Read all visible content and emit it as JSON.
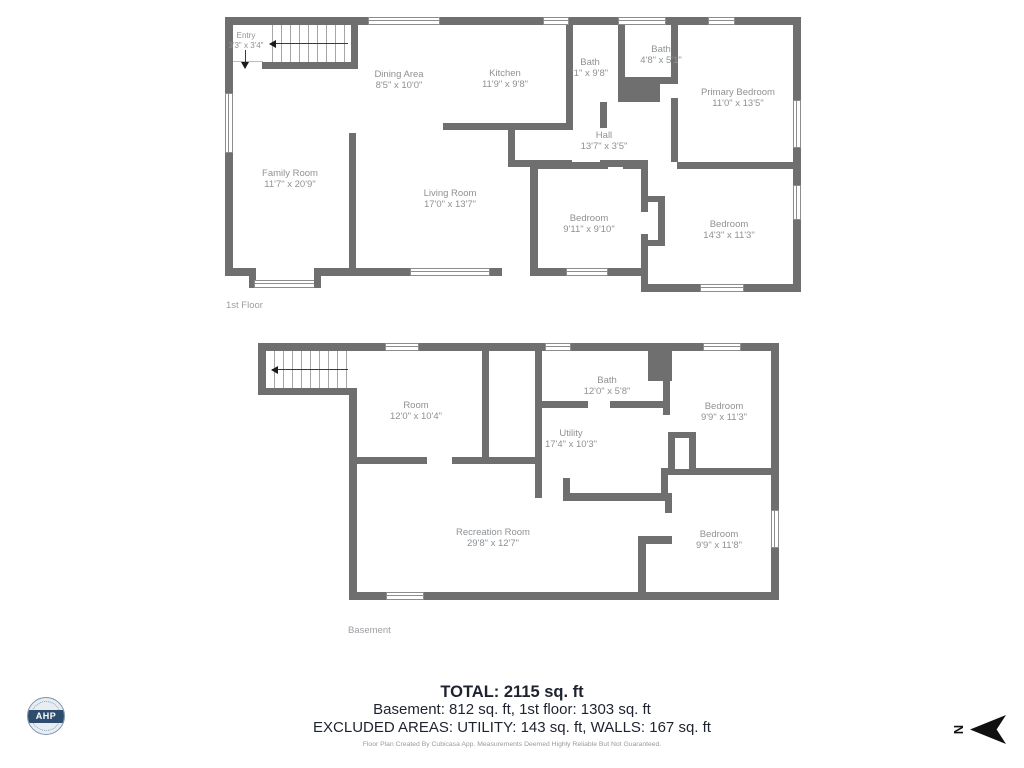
{
  "floors": [
    {
      "label": "1st Floor",
      "rooms": [
        {
          "name": "Entry",
          "dims": "3'3\" x 3'4\""
        },
        {
          "name": "Dining Area",
          "dims": "8'5\" x 10'0\""
        },
        {
          "name": "Kitchen",
          "dims": "11'9\" x 9'8\""
        },
        {
          "name": "Bath",
          "dims": "'1\" x 9'8\""
        },
        {
          "name": "Bath",
          "dims": "4'8\" x 5'1\""
        },
        {
          "name": "Primary Bedroom",
          "dims": "11'0\" x 13'5\""
        },
        {
          "name": "Hall",
          "dims": "13'7\" x 3'5\""
        },
        {
          "name": "Family Room",
          "dims": "11'7\" x 20'9\""
        },
        {
          "name": "Living Room",
          "dims": "17'0\" x 13'7\""
        },
        {
          "name": "Bedroom",
          "dims": "9'11\" x 9'10\""
        },
        {
          "name": "Bedroom",
          "dims": "14'3\" x 11'3\""
        }
      ]
    },
    {
      "label": "Basement",
      "rooms": [
        {
          "name": "Room",
          "dims": "12'0\" x 10'4\""
        },
        {
          "name": "Bath",
          "dims": "12'0\" x 5'8\""
        },
        {
          "name": "Utility",
          "dims": "17'4\" x 10'3\""
        },
        {
          "name": "Bedroom",
          "dims": "9'9\" x 11'3\""
        },
        {
          "name": "Recreation Room",
          "dims": "29'8\" x 12'7\""
        },
        {
          "name": "Bedroom",
          "dims": "9'9\" x 11'8\""
        }
      ]
    }
  ],
  "summary": {
    "total": "TOTAL: 2115 sq. ft",
    "floors_line": "Basement: 812 sq. ft, 1st floor: 1303 sq. ft",
    "excluded_line": "EXCLUDED AREAS: UTILITY: 143 sq. ft, WALLS: 167 sq. ft",
    "disclaimer": "Floor Plan Created By Cubicasa App. Measurements Deemed Highly Reliable But Not Guaranteed."
  },
  "logo": {
    "text": "AHP"
  },
  "compass": {
    "letter": "N"
  },
  "colors": {
    "wall": "#6f6f6f",
    "room_text": "#8e9194",
    "summary_text": "#1f2330",
    "logo_navy": "#2e4d6e"
  }
}
